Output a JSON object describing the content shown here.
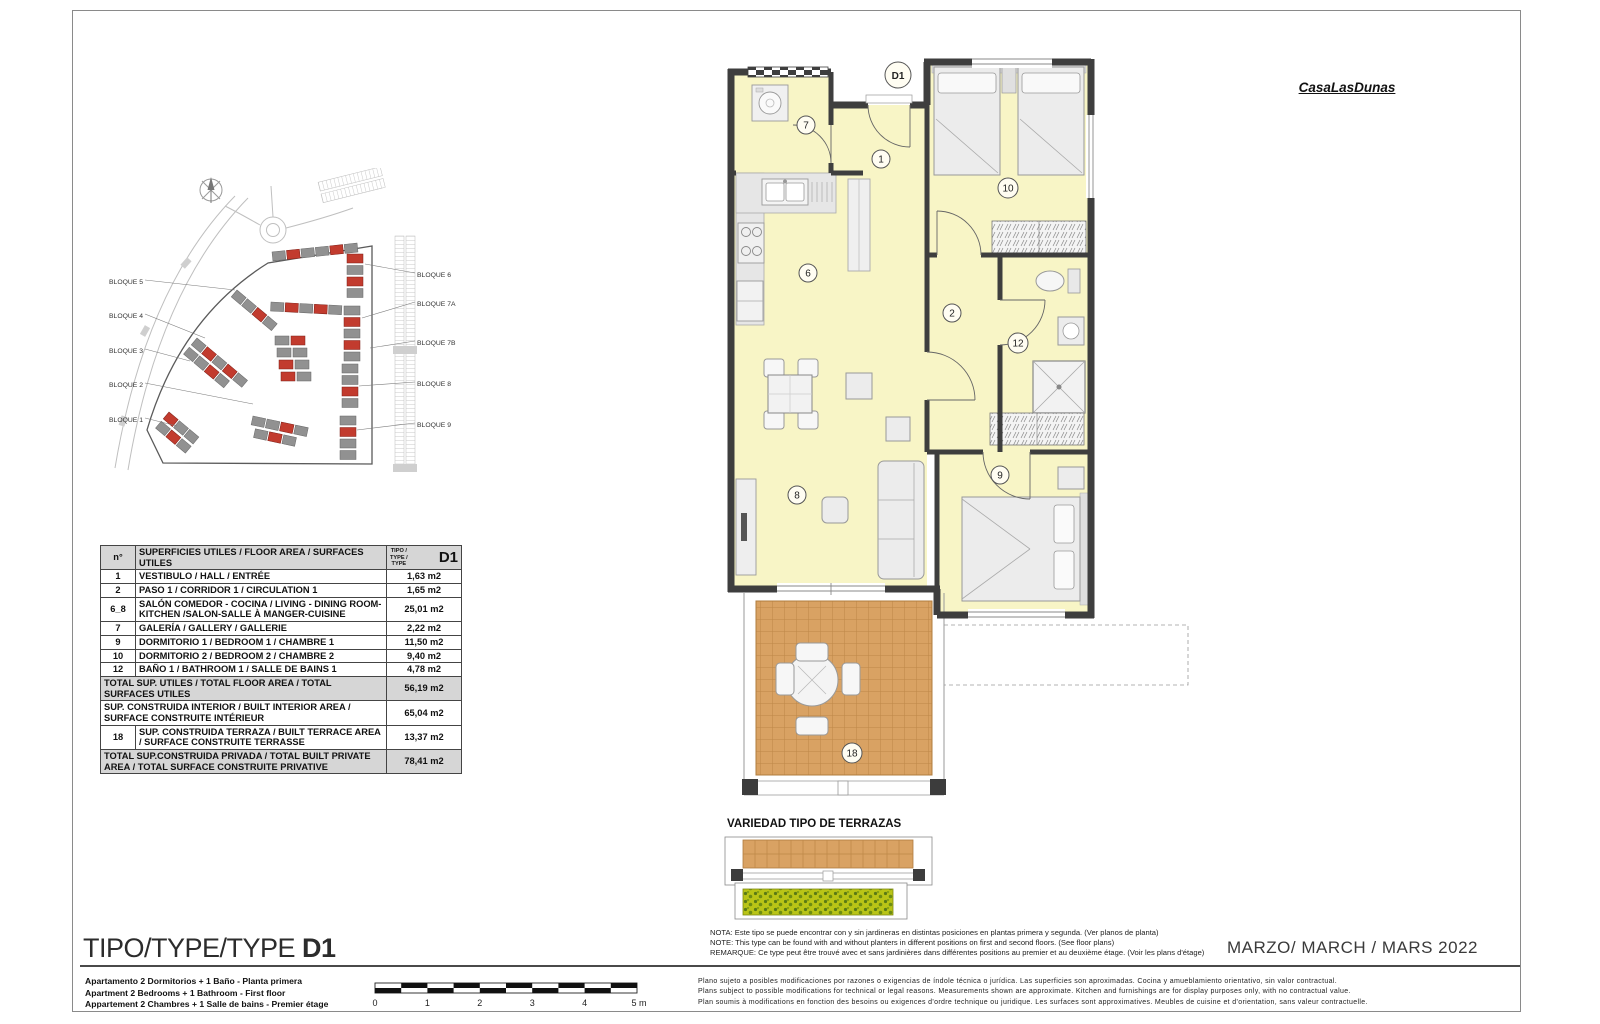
{
  "logo": "CasaLasDunas",
  "site_plan": {
    "labels_left": [
      "BLOQUE 5",
      "BLOQUE 4",
      "BLOQUE 3",
      "BLOQUE 2",
      "BLOQUE 1"
    ],
    "labels_right": [
      "BLOQUE 6",
      "BLOQUE 7A",
      "BLOQUE 7B",
      "BLOQUE 8",
      "BLOQUE 9"
    ]
  },
  "area_table": {
    "header": {
      "col_num": "n°",
      "col_desc": "SUPERFICIES UTILES / FLOOR AREA / SURFACES UTILES",
      "col_type_l1": "TIPO /",
      "col_type_l2": "TYPE /",
      "col_type_l3": "TYPE",
      "type_code": "D1"
    },
    "rows": [
      {
        "num": "1",
        "desc": "VESTIBULO / HALL / ENTRÉE",
        "value": "1,63 m2"
      },
      {
        "num": "2",
        "desc": "PASO 1 / CORRIDOR 1 / CIRCULATION 1",
        "value": "1,65 m2"
      },
      {
        "num": "6_8",
        "desc": "SALÓN COMEDOR - COCINA / LIVING - DINING ROOM-KITCHEN /SALON-SALLE À MANGER-CUISINE",
        "value": "25,01 m2"
      },
      {
        "num": "7",
        "desc": "GALERÍA / GALLERY / GALLERIE",
        "value": "2,22 m2"
      },
      {
        "num": "9",
        "desc": "DORMITORIO 1 / BEDROOM 1 / CHAMBRE 1",
        "value": "11,50 m2"
      },
      {
        "num": "10",
        "desc": "DORMITORIO 2 / BEDROOM 2 / CHAMBRE 2",
        "value": "9,40 m2"
      },
      {
        "num": "12",
        "desc": "BAÑO 1 / BATHROOM 1 / SALLE DE BAINS 1",
        "value": "4,78 m2"
      }
    ],
    "summary": [
      {
        "num": "",
        "desc": "TOTAL SUP. UTILES / TOTAL FLOOR AREA / TOTAL SURFACES UTILES",
        "value": "56,19 m2"
      },
      {
        "num": "",
        "desc": "SUP. CONSTRUIDA INTERIOR / BUILT INTERIOR AREA / SURFACE CONSTRUITE INTÉRIEUR",
        "value": "65,04 m2"
      },
      {
        "num": "18",
        "desc": "SUP. CONSTRUIDA TERRAZA / BUILT TERRACE AREA / SURFACE CONSTRUITE TERRASSE",
        "value": "13,37 m2"
      },
      {
        "num": "",
        "desc": "TOTAL SUP.CONSTRUIDA PRIVADA / TOTAL  BUILT PRIVATE AREA / TOTAL SURFACE CONSTRUITE PRIVATIVE",
        "value": "78,41 m2"
      }
    ]
  },
  "plan": {
    "title": "D1",
    "labels": {
      "hall": "1",
      "corridor": "2",
      "kitchen": "6",
      "galeria": "7",
      "living": "8",
      "bedroom1": "9",
      "bedroom2": "10",
      "bathroom": "12",
      "terrace": "18"
    }
  },
  "terrace_section": {
    "title": "VARIEDAD TIPO DE TERRAZAS"
  },
  "notes": {
    "es": "NOTA: Este tipo se puede encontrar con y sin jardineras en distintas posiciones en plantas primera y segunda. (Ver planos de planta)",
    "en": "NOTE: This type can be found with and without planters in different positions on first and second floors. (See floor plans)",
    "fr": "REMARQUE: Ce type peut être trouvé avec et sans jardinières dans différentes positions au premier et au deuxième étage. (Voir les plans d'étage)"
  },
  "footer": {
    "type_label": "TIPO/TYPE/TYPE ",
    "type_code": "D1",
    "desc_es": "Apartamento 2 Dormitorios + 1 Baño - Planta primera",
    "desc_en": "Apartment 2 Bedrooms + 1 Bathroom - First floor",
    "desc_fr": "Appartement 2 Chambres + 1 Salle de bains - Premier étage",
    "date": "MARZO/ MARCH / MARS  2022",
    "legal_es": "Plano sujeto a posibles modificaciones por razones o exigencias de índole técnica o jurídica. Las superficies son aproximadas. Cocina y amueblamiento orientativo, sin valor contractual.",
    "legal_en": "Plans subject to possible modifications for technical or legal reasons. Measurements shown are approximate. Kitchen and furnishings are for display purposes only, with no contractual value.",
    "legal_fr": "Plan soumis à modifications en fonction des besoins ou exigences d'ordre technique ou juridique. Les surfaces sont approximatives. Meubles de cuisine et d'orientation, sans valeur contractuelle.",
    "scale_labels": [
      "0",
      "1",
      "2",
      "3",
      "4",
      "5 m"
    ]
  },
  "colors": {
    "wall": "#3e3e3e",
    "room_fill": "#f8f5c6",
    "terrace_fill": "#d9a263",
    "accent_red": "#c23b2e",
    "table_gray": "#d6d6d6",
    "planter_green": "#b9c416"
  }
}
